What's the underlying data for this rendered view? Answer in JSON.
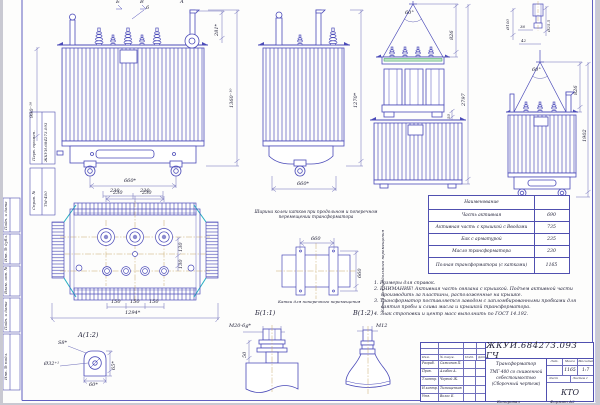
{
  "drawing": {
    "doc_number": "ЖКУИ.684273.093 ГЧ",
    "title_line1": "Трансформатор",
    "title_line2": "ТМГ-400 со сниженной себестоимостью",
    "title_line3": "(Сборочный чертеж)",
    "org": "КТО",
    "format_label": "Формат  А2",
    "copied_label": "Копировал",
    "lit_label": "Лит.",
    "mass_label": "Масса",
    "scale_label": "Масштаб",
    "mass_value": "1165",
    "scale_value": "1:7",
    "sheet_label": "Лист",
    "sheets_label": "Листов 1",
    "sig_h1": "Изм.",
    "sig_h2": "Лист",
    "sig_h3": "№ докум.",
    "sig_h4": "Подп.",
    "sig_h5": "Дата",
    "sig_rows": [
      {
        "role": "Разраб.",
        "name": "Самсонов П."
      },
      {
        "role": "Пров.",
        "name": "Алибек А."
      },
      {
        "role": "Т.контр.",
        "name": "Черной Ж."
      },
      {
        "role": "Н.контр.",
        "name": "Тимощенков"
      },
      {
        "role": "Утв.",
        "name": "Волос Е."
      }
    ]
  },
  "margin": {
    "perv_label": "Перв. примен.",
    "perv_value": "ЖКУИ.684273.093",
    "sprav_label": "Справ. №",
    "sprav_value": "ТМ-400",
    "podp1": "Подп. и дата",
    "inv_dubl": "Инв. № дубл.",
    "vzam": "Взам. инв. №",
    "podp2": "Подп. и дата",
    "inv_podl": "Инв. № подл."
  },
  "views": {
    "front": {
      "label_b": "Б",
      "label_v": "В",
      "label_a": "А",
      "callout": "6",
      "dim_tank_h": "990⁻¹⁰",
      "dim_total_h": "1360⁻¹⁰",
      "dim_bushing": "281*",
      "dim_track": "660*",
      "dim_sp1": "230",
      "dim_sp2": "230"
    },
    "side": {
      "dim_h": "1270*",
      "dim_w": "660*"
    },
    "active": {
      "angle": "60°",
      "dim_sling": "826",
      "dim_total": "2797",
      "dim_gap": "50"
    },
    "rear": {
      "angle": "60°",
      "dim_sling": "826",
      "dim_h": "1902"
    },
    "pin": {
      "dia1": "Ø100",
      "len1": "36",
      "len2": "42",
      "dia2": "Ø25.5"
    },
    "plan": {
      "t1": "230",
      "t2": "230",
      "r1": "130",
      "r2": "130",
      "b1": "150",
      "b2": "150",
      "b3": "150",
      "total": "1294*"
    },
    "track": {
      "caption": "Ширина колеи катков при продольном и поперечном перемещении трансформатора",
      "dim_h": "660",
      "dim_v": "660",
      "label_long": "Катки для продольного перемещения",
      "label_cross": "Катки для поперечного перемещения"
    },
    "detail_a": {
      "title": "А(1:2)",
      "s": "S8*",
      "dia": "Ø32⁺¹",
      "w": "60*",
      "h": "65*"
    },
    "detail_b": {
      "title": "Б(1:1)",
      "thread": "М20-6g*",
      "h": "50"
    },
    "detail_v": {
      "title": "В(1:2)",
      "thread": "М12"
    }
  },
  "mass_table": {
    "header": "Наименование",
    "header2": "",
    "rows": [
      {
        "label": "Часть активная",
        "value": "690"
      },
      {
        "label": "Активная часть с крышкой с Вводами",
        "value": "735"
      },
      {
        "label": "Бак с арматурой",
        "value": "235"
      },
      {
        "label": "Масло трансформатора",
        "value": "230"
      },
      {
        "label": "Полная трансформатора (с катками)",
        "value": "1165"
      }
    ]
  },
  "notes": [
    "1. Размеры для справок.",
    "2. ВНИМАНИЕ! Активная часть связана с крышкой. Подъем активной части производить за пластины, расположенные на крышке.",
    "3. Трансформатор поставляется заводом с запломбированными пробками для взятия пробы и слива масла и крышкой трансформатора.",
    "4. Знак строповки и центр масс выполнить по ГОСТ 14.192."
  ]
}
